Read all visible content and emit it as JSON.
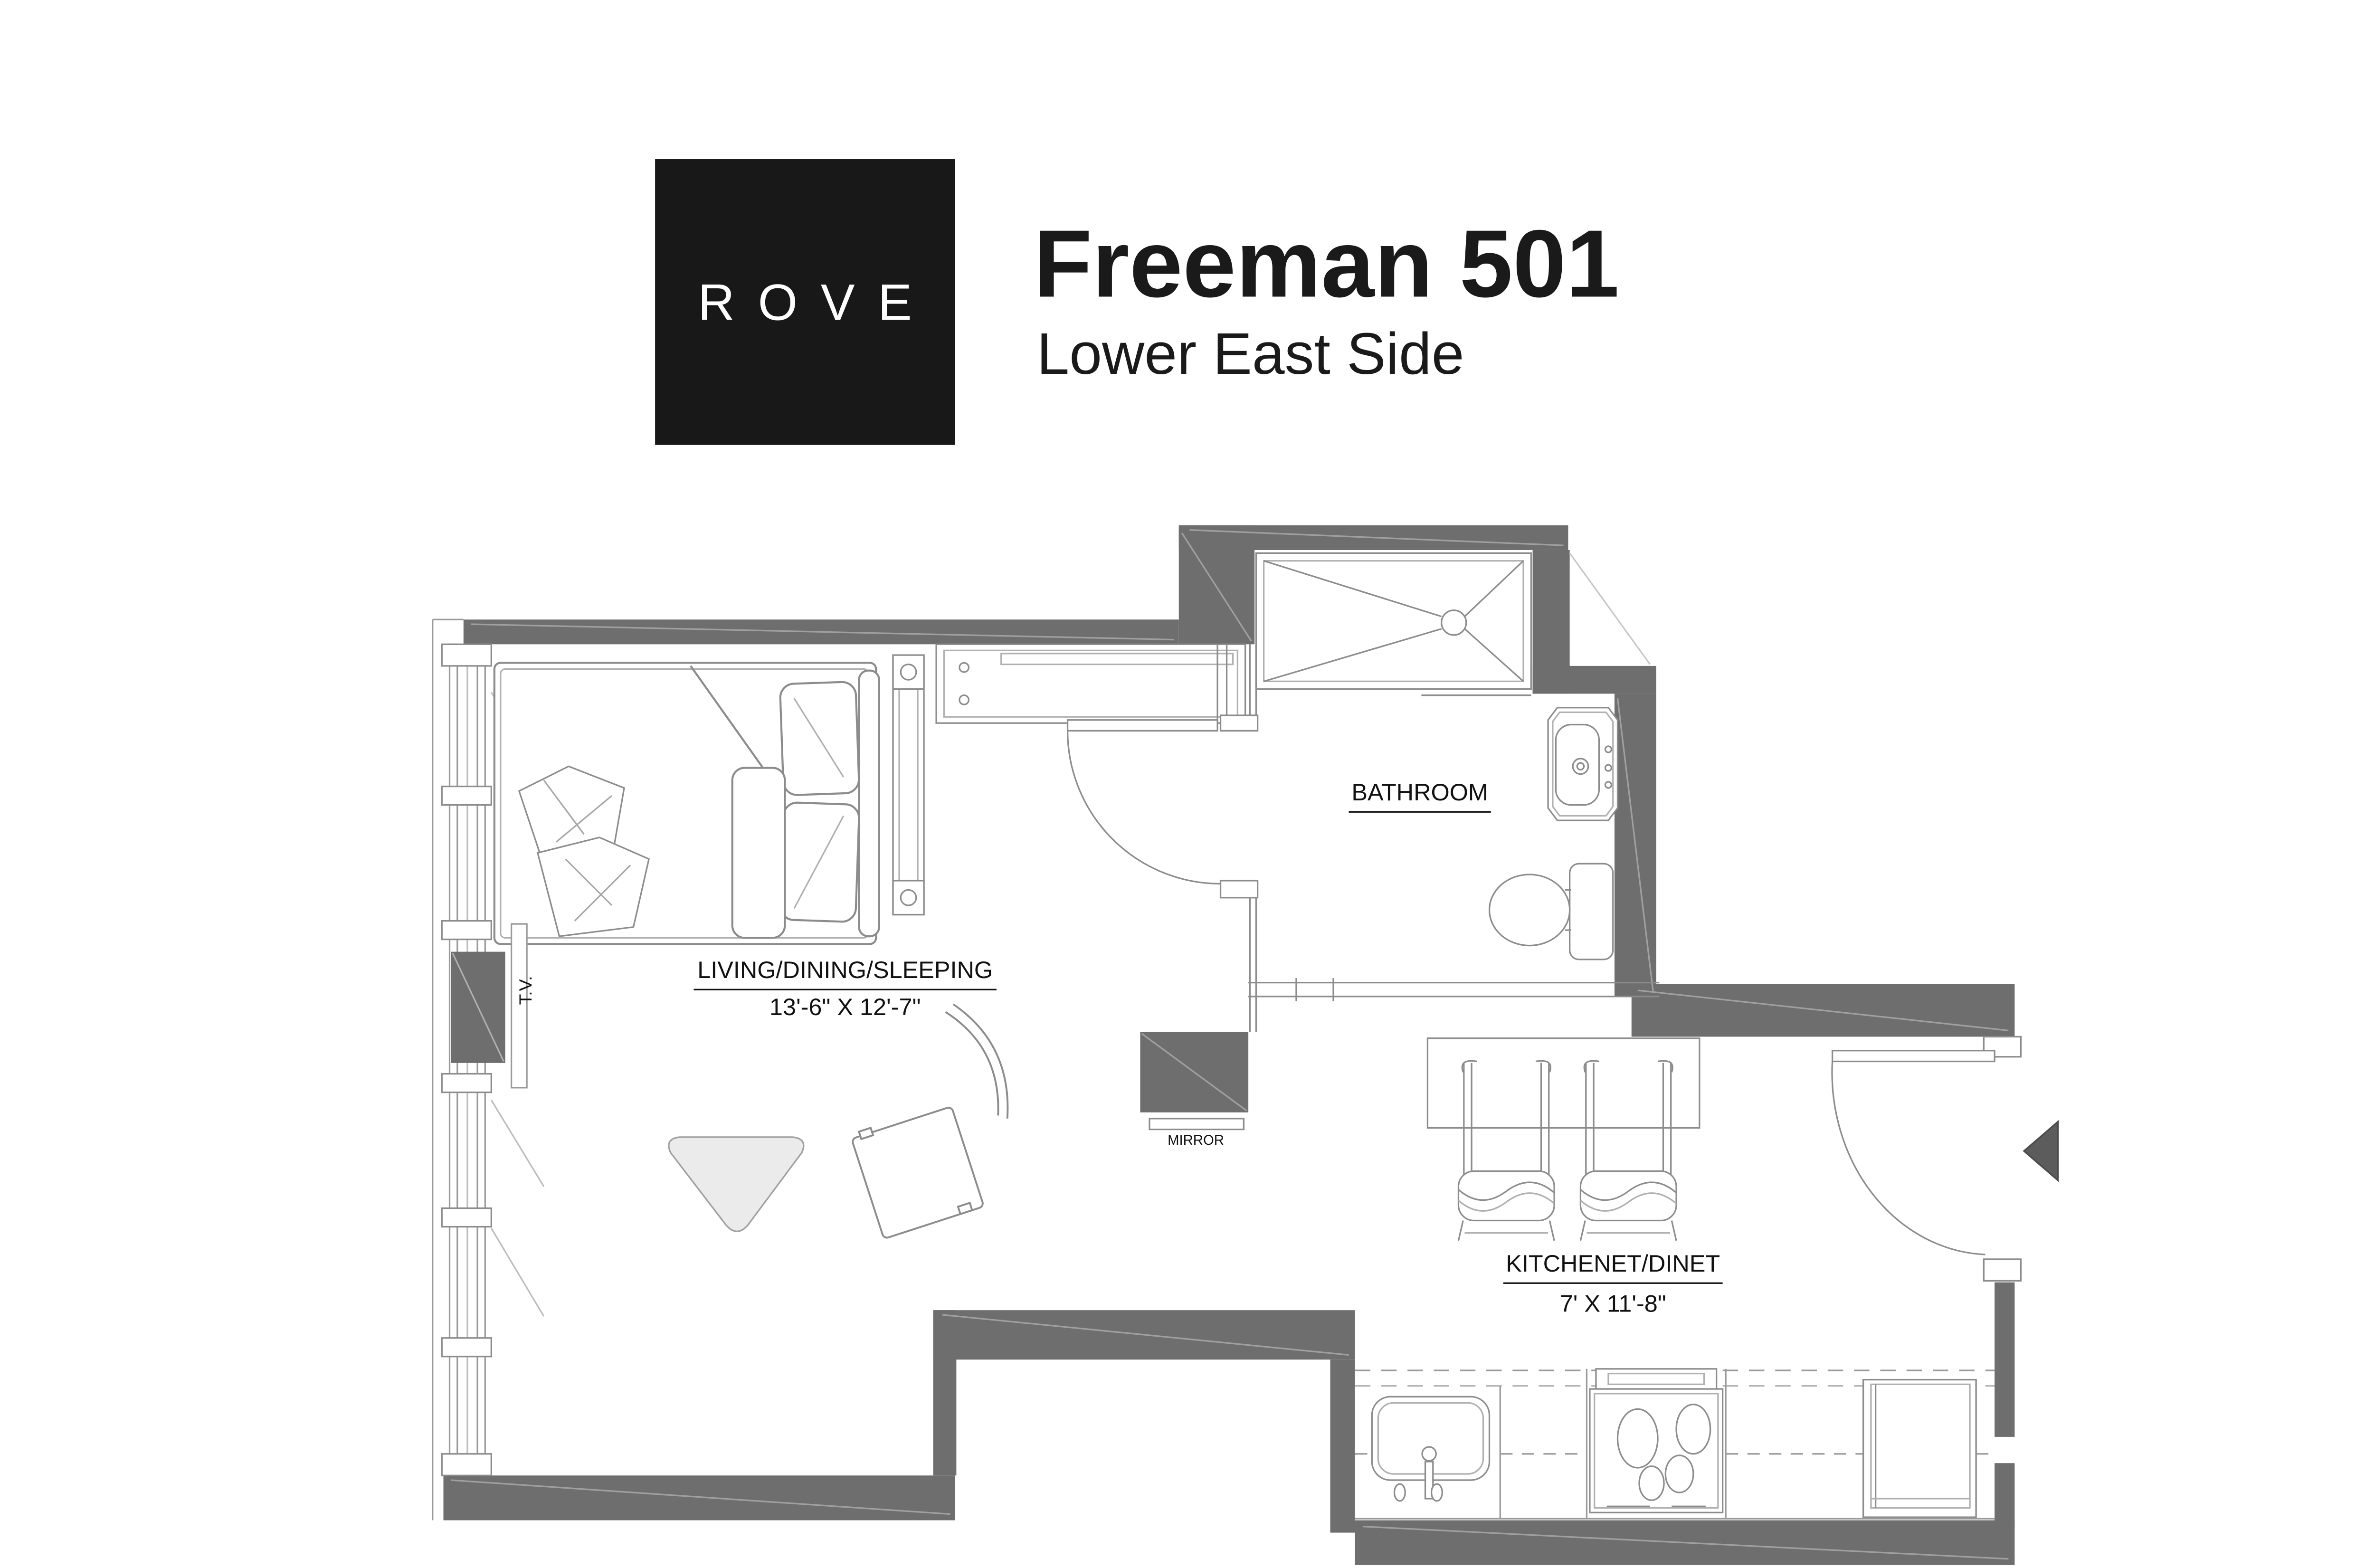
{
  "header": {
    "logo_text": "ROVE",
    "title": "Freeman 501",
    "subtitle": "Lower East Side"
  },
  "floor_plan": {
    "rooms": [
      {
        "name": "LIVING/DINING/SLEEPING",
        "dimensions": "13'-6\" X 12'-7\""
      },
      {
        "name": "BATHROOM",
        "dimensions": ""
      },
      {
        "name": "KITCHENET/DINET",
        "dimensions": "7' X 11'-8\""
      }
    ],
    "fixture_labels": {
      "tv": "T.V.",
      "mirror": "MIRROR"
    },
    "colors": {
      "wall_gray": "#6e6e6e",
      "logo_background": "#181818",
      "text": "#1a1a1a",
      "line_gray": "#8c8c8c",
      "rug_fill": "#ebebeb",
      "entry_marker": "#5c5c5c"
    }
  }
}
